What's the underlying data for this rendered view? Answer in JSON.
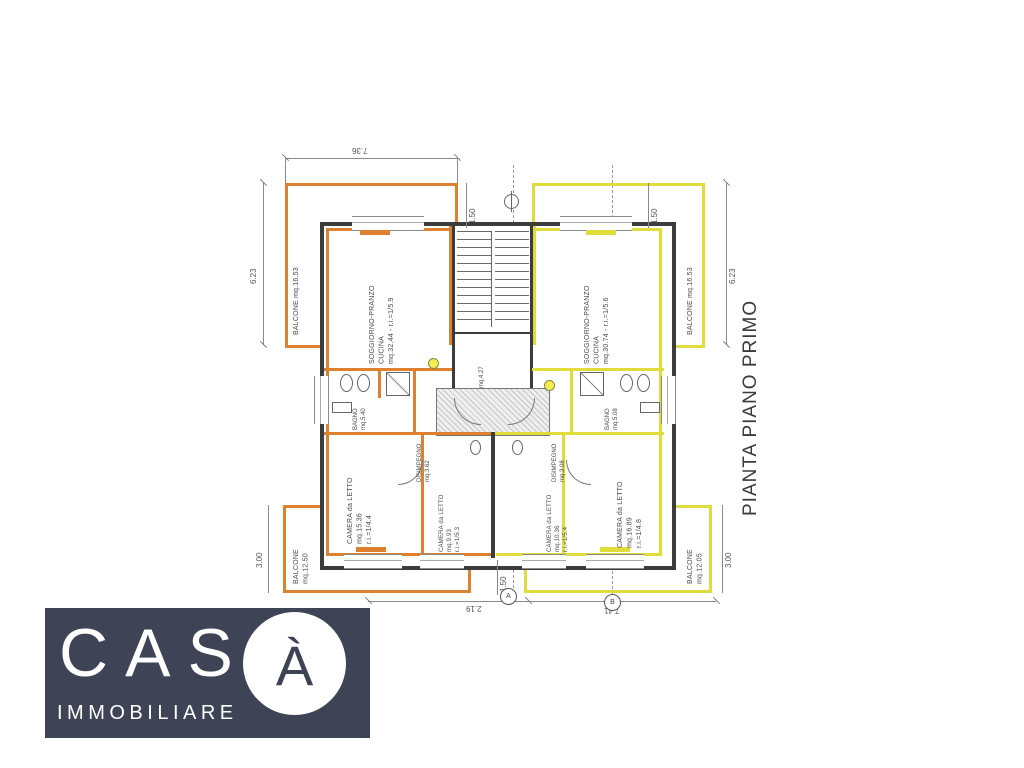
{
  "title": "PIANTA PIANO PRIMO",
  "logo": {
    "word": "CAS",
    "accent_letter": "À",
    "subtitle": "IMMOBILIARE"
  },
  "colors": {
    "left_apartment_accent": "#dd8030",
    "right_apartment_accent": "#e0dc3a",
    "wall": "#3c3c3c",
    "logo_background": "#3e4456"
  },
  "plan": {
    "labels": {
      "living_left": "SOGGIORNO-PRANZO\nCUCINA\nmq.32.44 - r.i.=1/5.9",
      "living_right": "SOGGIORNO-PRANZO\nCUCINA\nmq.30.74 - r.i.=1/5.6",
      "bedroom_left": "CAMERA da LETTO\nmq.15.36\nr.i.=1/4.4",
      "bedroom_center_left": "CAMERA da LETTO\nmq.9.93\nr.i.=1/5.3",
      "bedroom_center_right": "CAMERA da LETTO\nmq.10.36\nr.i.=1/5.4",
      "bedroom_right": "CAMERA da LETTO\nmq.16.89\nr.i.=1/4.8",
      "balcony_top_left": "BALCONE   mq.16.53",
      "balcony_top_right": "BALCONE   mq.16.53",
      "balcony_bottom_left": "BALCONE\nmq.12.50",
      "balcony_bottom_right": "BALCONE\nmq.12.05",
      "hall_left": "DISIMPEGNO\nmq.3.62",
      "hall_right": "DISIMPEGNO\nmq.3.08",
      "bath_left": "BAGNO\nmq.5.40",
      "bath_right": "BAGNO\nmq.5.08",
      "entry": "mq.4.27"
    },
    "dimensions": {
      "top_balcony_width": "7.36",
      "top_gap_left": "1.50",
      "top_gap_right": "1.50",
      "side_left": "6.23",
      "side_right": "6.23",
      "bottom_side_left": "3.00",
      "bottom_side_right": "3.00",
      "bottom_span_left": "2.19",
      "bottom_span_right": "7.41",
      "bottom_gap": "1.50"
    },
    "section_markers": {
      "left": "A",
      "right": "B"
    }
  }
}
